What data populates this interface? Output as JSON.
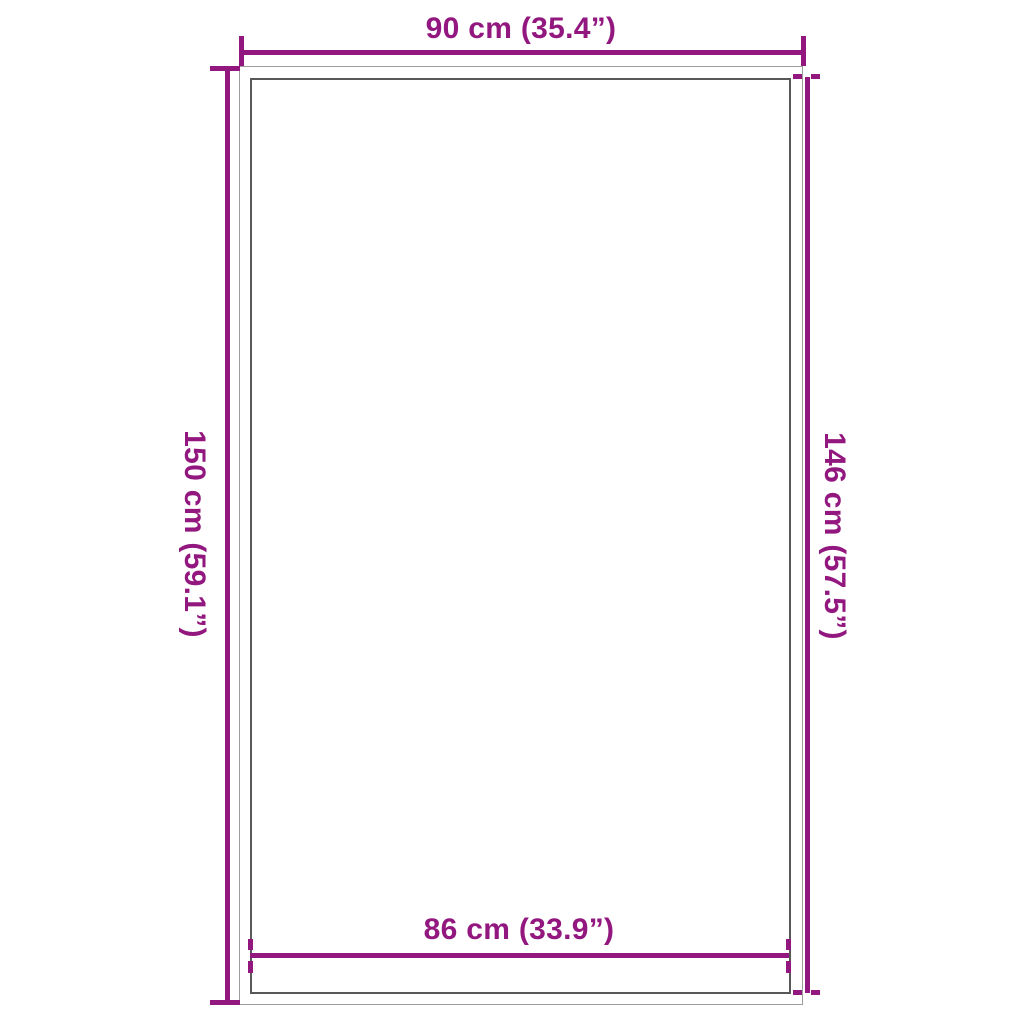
{
  "diagram": {
    "kind": "product-dimension-diagram",
    "shape": "rectangle-with-border",
    "dimensions": {
      "outer_width": {
        "position": "top",
        "label": "90 cm (35.4”)",
        "cm": 90,
        "inches": 35.4,
        "tick_style": "solid"
      },
      "outer_height": {
        "position": "left",
        "label": "150 cm (59.1”)",
        "cm": 150,
        "inches": 59.1,
        "tick_style": "solid"
      },
      "inner_height": {
        "position": "right",
        "label": "146 cm (57.5”)",
        "cm": 146,
        "inches": 57.5,
        "tick_style": "dashed"
      },
      "inner_width": {
        "position": "bottom",
        "label": "86 cm (33.9”)",
        "cm": 86,
        "inches": 33.9,
        "tick_style": "dashed"
      }
    },
    "colors": {
      "accent": "#92187F",
      "outer_rect_stroke": "#9D9D9C",
      "inner_rect_stroke": "#585856",
      "background": "#FFFFFF"
    }
  }
}
